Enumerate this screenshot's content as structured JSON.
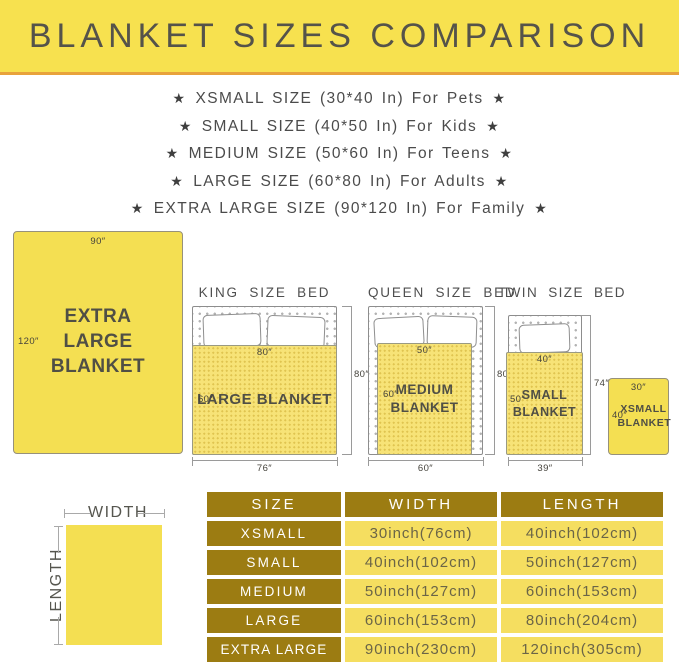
{
  "banner": {
    "title": "BLANKET SIZES COMPARISON"
  },
  "star": "★",
  "size_list": [
    {
      "text": "XSMALL SIZE (30*40 In) For Pets"
    },
    {
      "text": "SMALL SIZE (40*50 In) For Kids"
    },
    {
      "text": "MEDIUM SIZE (50*60 In) For Teens"
    },
    {
      "text": "LARGE SIZE (60*80 In) For Adults"
    },
    {
      "text": "EXTRA LARGE SIZE (90*120 In) For Family"
    }
  ],
  "diagram": {
    "xl_blanket": {
      "width_dim": "90″",
      "length_dim": "120″",
      "label": "EXTRA LARGE BLANKET"
    },
    "king": {
      "title": "KING SIZE BED",
      "blanket_width": "80″",
      "blanket_length": "60″",
      "blanket_label": "LARGE BLANKET",
      "bed_length": "80″",
      "bed_width": "76″"
    },
    "queen": {
      "title": "QUEEN SIZE BED",
      "blanket_width": "50″",
      "blanket_length": "60″",
      "blanket_label": "MEDIUM BLANKET",
      "bed_length": "80″",
      "bed_width": "60″"
    },
    "twin": {
      "title": "TWIN SIZE BED",
      "blanket_width": "40″",
      "blanket_length": "50″",
      "blanket_label": "SMALL BLANKET",
      "bed_length": "74″",
      "bed_width": "39″"
    },
    "xs_blanket": {
      "width_dim": "30″",
      "length_dim": "40″",
      "label": "XSMALL BLANKET"
    },
    "legend": {
      "width": "WIDTH",
      "length": "LENGTH"
    }
  },
  "table": {
    "headers": {
      "size": "SIZE",
      "width": "WIDTH",
      "length": "LENGTH"
    },
    "rows": [
      {
        "size": "XSMALL",
        "width": "30inch(76cm)",
        "length": "40inch(102cm)"
      },
      {
        "size": "SMALL",
        "width": "40inch(102cm)",
        "length": "50inch(127cm)"
      },
      {
        "size": "MEDIUM",
        "width": "50inch(127cm)",
        "length": "60inch(153cm)"
      },
      {
        "size": "LARGE",
        "width": "60inch(153cm)",
        "length": "80inch(204cm)"
      },
      {
        "size": "EXTRA LARGE",
        "width": "90inch(230cm)",
        "length": "120inch(305cm)"
      }
    ]
  },
  "colors": {
    "banner_yellow": "#F7E14F",
    "banner_border_orange": "#E8A23C",
    "blanket_yellow": "#F4DF52",
    "bed_blanket_yellow": "#F7E377",
    "table_header_gold": "#9C7C12",
    "table_cell_yellow": "#F5DE60",
    "text_dark": "#4B4B4B"
  }
}
